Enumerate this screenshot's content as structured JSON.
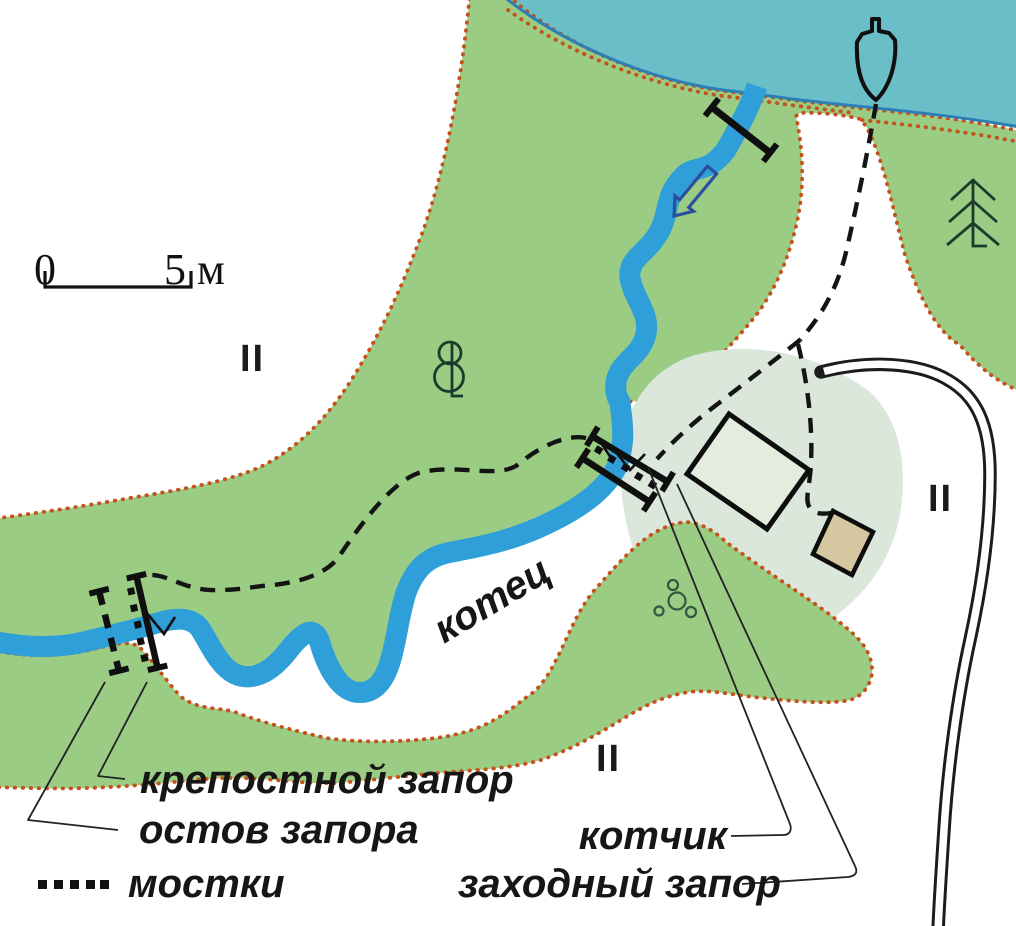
{
  "map": {
    "scale_bar": {
      "start_label": "0",
      "end_label": "5 м"
    },
    "region_labels": {
      "upper_left": "II",
      "right": "II",
      "bottom": "II"
    },
    "river_pool_label": "котец",
    "callouts": {
      "fortress_barrier": "крепостной запор",
      "barrier_frame": "остов запора",
      "trap": "котчик",
      "entry_barrier": "заходный запор"
    },
    "legend": {
      "walkways_label": "мостки",
      "walkways_symbol": "dotted-row"
    },
    "colors": {
      "lake": "#69bec8",
      "shoreline": "#2d7eb5",
      "river": "#2e9fd8",
      "vegetation": "#9bcc84",
      "boundary_dots": "#c4531b",
      "clearing_halo": "#dbe7da",
      "building_large_fill": "#e5ecdd",
      "building_small_fill": "#d5c7a0",
      "flow_arrow": "#2b4f9e",
      "tree_glyph": "#1d3b2a",
      "ink": "#141414"
    },
    "icons": [
      "boat-icon",
      "deciduous-tree-icon",
      "spruce-tree-icon",
      "flow-arrow-icon",
      "stones-icon",
      "footbridge-icon",
      "weir-bar-icon",
      "walkway-dots-icon"
    ]
  }
}
